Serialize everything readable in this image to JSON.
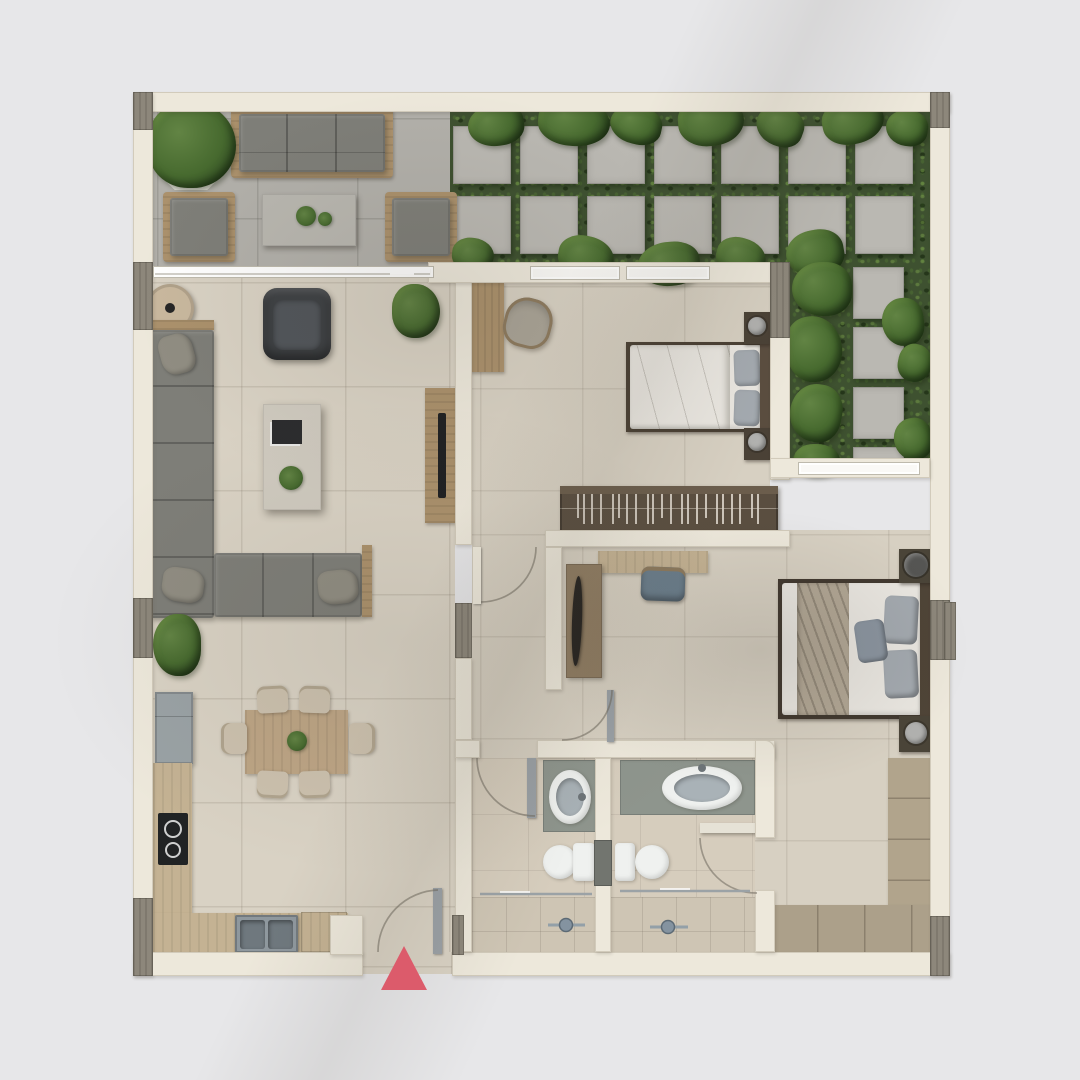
{
  "scene": {
    "type": "architectural floor plan, top-down 3D render",
    "background": "#e7e7e9",
    "visible_text": "none"
  },
  "palette": {
    "bg": "#e7e7e9",
    "wall": "#ede8db",
    "wallAccent": "#8d877b",
    "floorMain": "#d9d2c4",
    "floorBed": "#d7d0c2",
    "floorBath": "#d6cdbd",
    "floorShower": "#cec5b4",
    "terrace": "#b2b0aa",
    "paver": "#bab8b2",
    "paverLine": "#a3a19b",
    "gardenBase": "#3e5130",
    "leafLight": "#628444",
    "leafMid": "#476a2f",
    "leafDark": "#2a4220",
    "woodLight": "#c4b293",
    "wood": "#ab916c",
    "woodMid": "#8f7c62",
    "woodDark": "#54483a",
    "sofa": "#7e7e78",
    "cushion": "#908d82",
    "charcoal": "#3e4144",
    "concrete": "#cfcabf",
    "bedding": "#eae7e1",
    "pillowGrey": "#a4aab0",
    "throw": "#b2a795",
    "lampLight": "#b1b1af",
    "lampDark": "#555553",
    "fridge": "#9aa2a5",
    "steel": "#8f989e",
    "steelDark": "#6f787e",
    "cooktop": "#212324",
    "bathCounter": "#8e958d",
    "fixtureWhite": "#eff1ef",
    "bowl": "#a9b2b7",
    "glassLine": "#9ba2a6",
    "window": "#faf9f6",
    "marker": "#dc5b6b",
    "doorPanel": "#9aa0a5",
    "arcLine": "#6e685c",
    "chairSeat": "#ccc1ae",
    "chairBlue": "#6b7e8c",
    "mirrorDark": "#262320"
  },
  "entrance": {
    "marker_shape": "upward-triangle",
    "marker_color": "#dc5b6b"
  },
  "garden": {
    "paver_columns": 7,
    "paver_rows": 2,
    "side_pavers": 4
  },
  "closet": {
    "hanger_ticks": 22
  },
  "rooms": [
    "terrace",
    "garden",
    "living-room",
    "kitchen-dining",
    "hallway",
    "bedroom-1",
    "bedroom-2",
    "bathroom-1",
    "bathroom-2"
  ],
  "furniture_inventory": {
    "terrace": [
      "potted-plant",
      "outdoor-sofa-3-seat",
      "outdoor-armchair-left",
      "outdoor-armchair-right",
      "outdoor-coffee-table"
    ],
    "living-room": [
      "round-side-table",
      "l-shaped-sofa",
      "lounge-chair",
      "coffee-table",
      "tv-console",
      "plants"
    ],
    "kitchen-dining": [
      "fridge",
      "l-shaped-counter",
      "cooktop",
      "double-sink",
      "cabinet",
      "dining-table",
      "dining-chairs-x6"
    ],
    "bedroom-1": [
      "desk",
      "desk-chair",
      "double-bed",
      "nightstands-x2",
      "wardrobe-with-hangers"
    ],
    "bedroom-2": [
      "desk",
      "desk-chair",
      "console-mirror",
      "double-bed",
      "nightstands-x2",
      "l-shaped-wardrobe"
    ],
    "bathroom-1": [
      "vanity-sink",
      "toilet",
      "walk-in-shower"
    ],
    "bathroom-2": [
      "vanity-sink",
      "toilet",
      "walk-in-shower",
      "shelf"
    ]
  }
}
